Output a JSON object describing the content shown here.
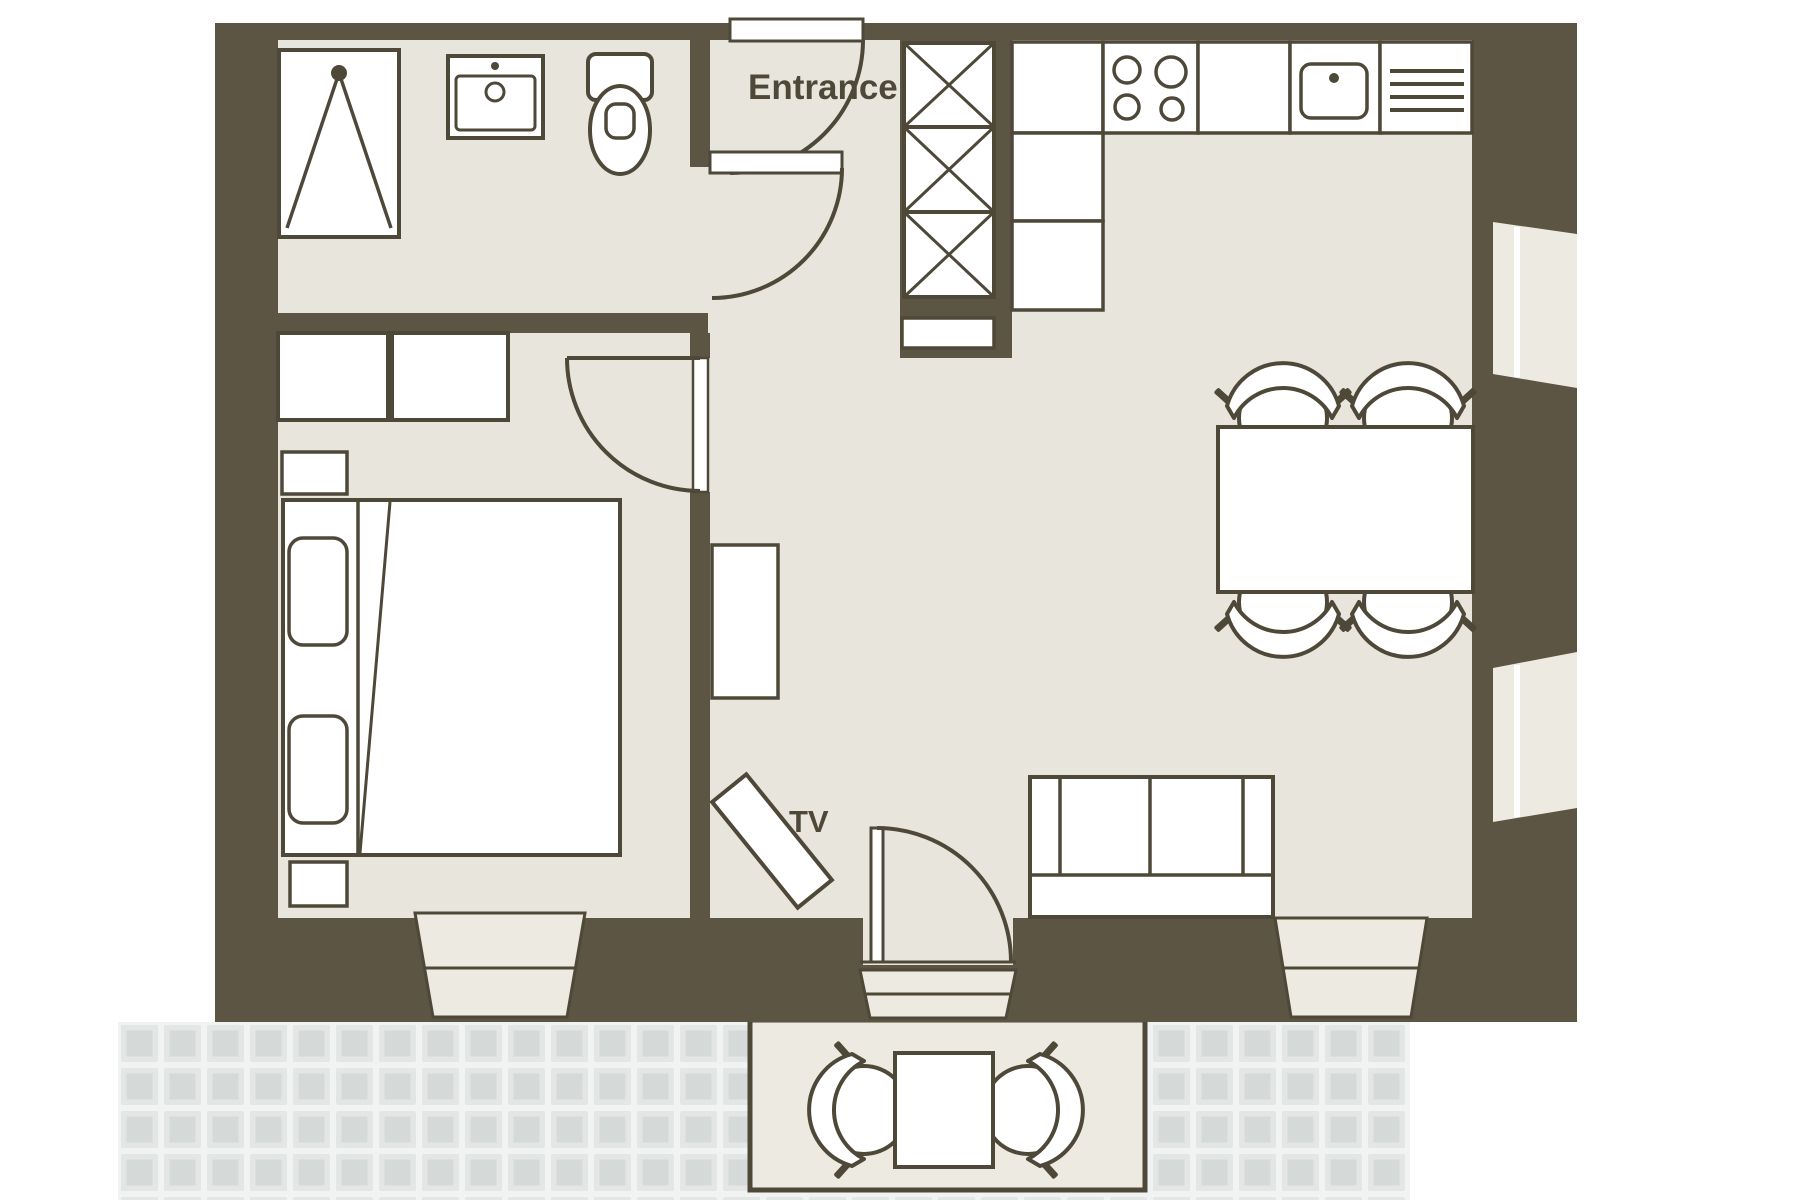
{
  "title": "Apartment floor plan",
  "labels": {
    "entrance": "Entrance",
    "tv": "TV"
  },
  "colors": {
    "wall": "#5c5544",
    "line": "#4e4839",
    "floor": "#e8e5dc",
    "floor2": "#edeae1",
    "white": "#ffffff",
    "tileGrout": "#f1f2f2",
    "tileFrame": "#e3e6e5",
    "tileFill": "#d5d9d8"
  },
  "elements": [
    "shower",
    "bathroom-sink",
    "toilet",
    "closet",
    "nightstand",
    "double-bed",
    "pillows",
    "entrance-door",
    "bathroom-door",
    "bedroom-door",
    "patio-door",
    "tall-cabinet",
    "kitchen-counter",
    "stove",
    "kitchen-sink",
    "drainer",
    "dining-table",
    "dining-chairs",
    "sofa",
    "tv",
    "tv-console",
    "right-wall-windows",
    "window-bays",
    "patio-terrace",
    "patio-table",
    "patio-chairs",
    "patio-tiles"
  ]
}
